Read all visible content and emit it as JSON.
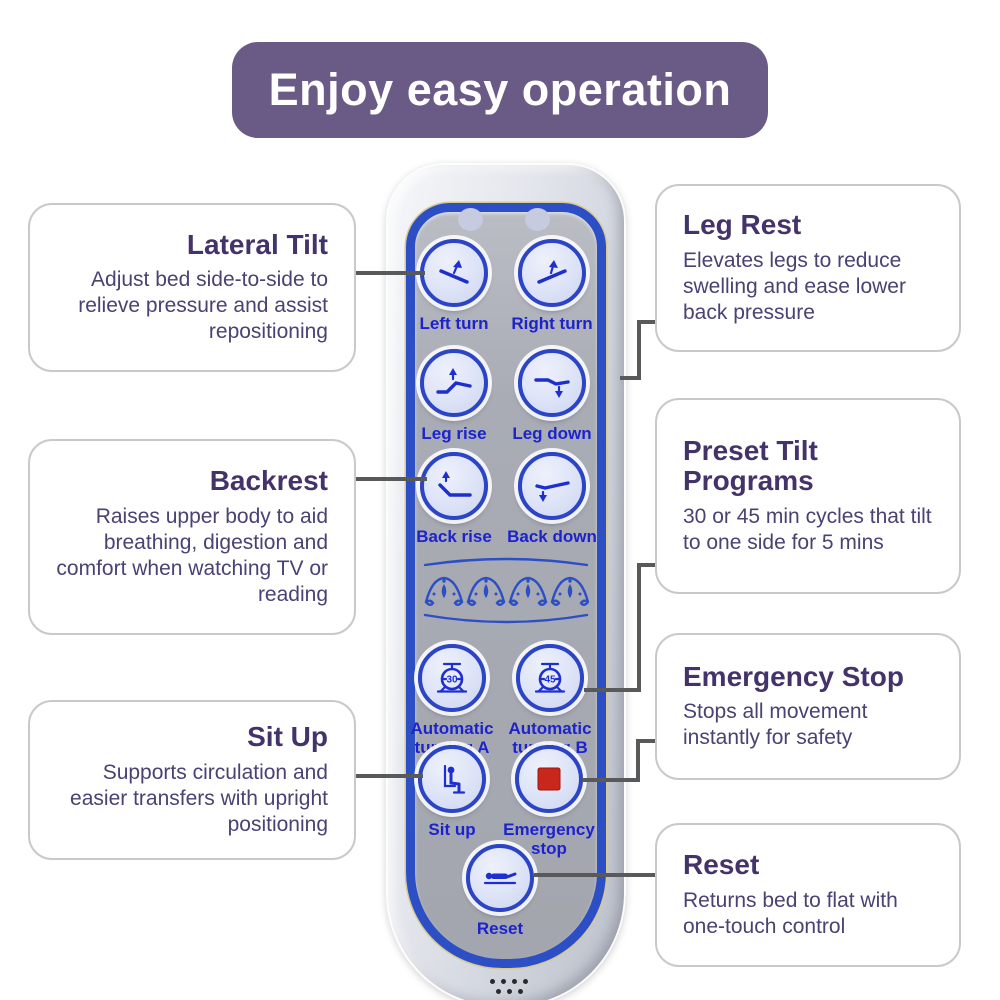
{
  "banner": {
    "title": "Enjoy easy operation"
  },
  "callouts_left": [
    {
      "title": "Lateral Tilt",
      "body": "Adjust bed side-to-side to relieve pressure and assist repositioning"
    },
    {
      "title": "Backrest",
      "body": "Raises upper body to aid breathing, digestion and comfort when watching TV or reading"
    },
    {
      "title": "Sit Up",
      "body": "Supports circulation and easier transfers with upright positioning"
    }
  ],
  "callouts_right": [
    {
      "title": "Leg Rest",
      "body": "Elevates legs to reduce swelling and ease lower back pressure"
    },
    {
      "title": "Preset Tilt Programs",
      "body": "30 or 45 min cycles that tilt to one side for 5 mins"
    },
    {
      "title": "Emergency Stop",
      "body": "Stops all movement instantly for safety"
    },
    {
      "title": "Reset",
      "body": "Returns bed to flat with one-touch control"
    }
  ],
  "remote": {
    "buttons": [
      {
        "label": "Left turn",
        "icon": "left-turn-icon"
      },
      {
        "label": "Right turn",
        "icon": "right-turn-icon"
      },
      {
        "label": "Leg rise",
        "icon": "leg-rise-icon"
      },
      {
        "label": "Leg down",
        "icon": "leg-down-icon"
      },
      {
        "label": "Back rise",
        "icon": "back-rise-icon"
      },
      {
        "label": "Back down",
        "icon": "back-down-icon"
      },
      {
        "label": "Automatic turning A",
        "icon": "timer-30-icon",
        "timer_value": "30"
      },
      {
        "label": "Automatic turning B",
        "icon": "timer-45-icon",
        "timer_value": "45"
      },
      {
        "label": "Sit up",
        "icon": "sit-up-icon"
      },
      {
        "label": "Emergency stop",
        "icon": "emergency-stop-icon"
      },
      {
        "label": "Reset",
        "icon": "reset-bed-icon"
      }
    ]
  },
  "colors": {
    "banner_bg": "#6a5b86",
    "heading_purple": "#44336a",
    "body_text_purple": "#4b4173",
    "button_label_blue": "#1c23cd",
    "panel_border_blue": "#2d4fc6",
    "panel_gray": "#a9acb4",
    "emergency_red": "#c9271b",
    "connector_gray": "#58595b"
  }
}
